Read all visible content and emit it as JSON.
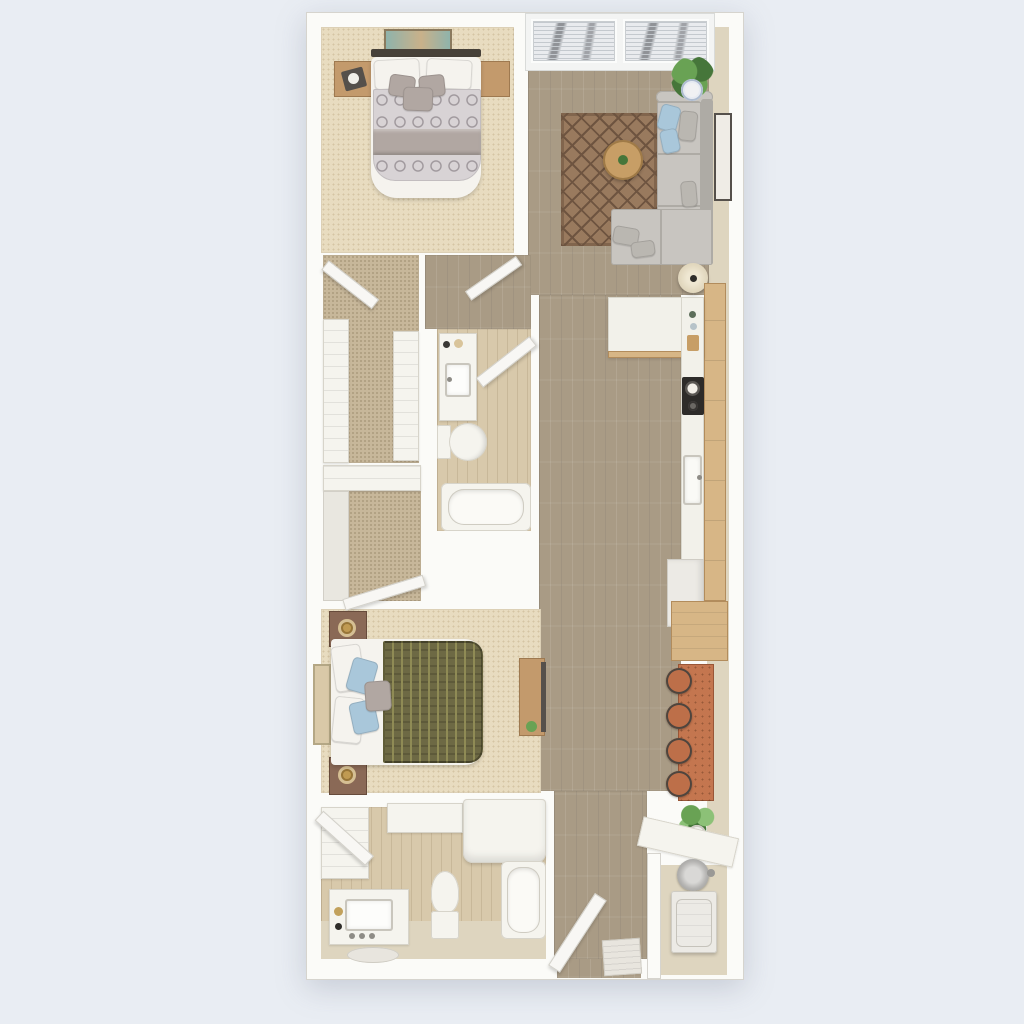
{
  "scene": {
    "label": "Top-down 3D rendered floor plan of a two-bedroom, two-bathroom apartment",
    "view": "top-down 3D render",
    "visible_text": "none"
  },
  "palette": {
    "bg": "#e9edf3",
    "wall": "#fbfbf8",
    "wall_edge": "#d6d4ce",
    "wall_tan": "#ddd3bd",
    "wood": "#a99b85",
    "wood_seam": "#8f8069",
    "bath_floor": "#d8c9ab",
    "floor_tan": "#ded5bf",
    "carpet": "#e8dcc0",
    "carpet_dot": "#d5c5a3",
    "carpet_dark": "#c7b79a",
    "rug": "#997a5e",
    "rug_line": "#6e5440",
    "sofa": "#c8c5c0",
    "sofa_seam": "#aeaba5",
    "pillow_blue": "#a9c7da",
    "pillow_gray": "#bab7b1",
    "table_wood": "#c79e66",
    "counter": "#f2f1ea",
    "cabinet": "#d7b686",
    "cabinet_line": "#b28c5c",
    "stove": "#2d2b29",
    "bar": "#c4764f",
    "stool": "#bd6f49",
    "stool_dark": "#4e453e",
    "plant": "#69a254",
    "plant_dark": "#46763a",
    "fixture": "#f5f4ee",
    "fixture_line": "#d7d4ca",
    "duvet1": "#d8d3d5",
    "duvet1_line": "#a19a9e",
    "blanket": "#b1a7a2",
    "sheet": "#f5f3ee",
    "duvet2": "#6d6944",
    "duvet2_line": "#8f8b55",
    "ns_light": "#c39a6c",
    "ns_dark": "#8a6956",
    "headboard": "#474139",
    "lamp_gold": "#c09a52",
    "heater": "#b4b3b1",
    "washer": "#eceae5",
    "door": "#f8f7f4",
    "door_edge": "#d3d1ca",
    "art_teal": "#8fb3ab",
    "art_sand": "#d9c9a8",
    "frame_dark": "#55504b",
    "blind": "#e9ebee",
    "blind_line": "#c4c9ce",
    "mat": "#e8e5de"
  },
  "rooms": [
    {
      "id": "bedroom-1",
      "label": "Bedroom 1 (top left)",
      "floor": "beige carpet",
      "items": [
        "wall art above headboard",
        "nightstand with decorative tray (left)",
        "nightstand (right)",
        "double bed with metal headboard",
        "2 white pillows",
        "3 taupe accent pillows",
        "ogee-patterned duvet",
        "folded taupe throw blanket"
      ]
    },
    {
      "id": "living-room",
      "label": "Living room (top right)",
      "floor": "hardwood planks",
      "items": [
        "two windows with horizontal blinds",
        "potted plant in corner",
        "patterned brown area rug",
        "gray L-sectional sofa",
        "blue and gray throw pillows",
        "round wood coffee table with small plant",
        "framed wall art on right wall",
        "round cream floor lamp"
      ]
    },
    {
      "id": "kitchen",
      "label": "Galley kitchen (right side)",
      "floor": "hardwood planks",
      "items": [
        "white L-shaped peninsula counter with wood base",
        "wood cabinet run along right wall",
        "black cooktop with pan",
        "undermount sink with faucet",
        "counter bottles",
        "white refrigerator",
        "wood buffet hutch"
      ]
    },
    {
      "id": "dining-nook",
      "label": "Dining bar (right side)",
      "floor": "hardwood planks",
      "items": [
        "terracotta bar-height table",
        "4 round bar stools",
        "potted plant"
      ]
    },
    {
      "id": "walk-in-closet-1",
      "label": "Walk-in closet 1 (middle left)",
      "floor": "dark tan carpet",
      "items": [
        "white shelving left",
        "white shelving right",
        "open closet door"
      ]
    },
    {
      "id": "bathroom-1",
      "label": "Bathroom 1 (middle)",
      "floor": "light wood",
      "items": [
        "vanity with sink and toiletries",
        "toilet",
        "bathtub",
        "open door"
      ]
    },
    {
      "id": "walk-in-closet-2",
      "label": "Walk-in closet 2 (left)",
      "floor": "dark tan carpet",
      "items": [
        "white shelf band",
        "wardrobe unit",
        "open closet door"
      ]
    },
    {
      "id": "bedroom-2",
      "label": "Bedroom 2 / primary (bottom left)",
      "floor": "beige carpet",
      "items": [
        "framed art on left wall",
        "2 dark-wood nightstands with brass lamps",
        "bed with white sheets",
        "white and blue pillows",
        "olive patterned duvet",
        "wood media console with TV"
      ]
    },
    {
      "id": "bathroom-2",
      "label": "Bathroom 2 (bottom)",
      "floor": "light wood with tan border",
      "items": [
        "walk-in closet shelving with open door",
        "white storage counter",
        "white shower/cabinet unit",
        "vanity with sink and faucet knobs",
        "bath mat",
        "toilet",
        "bathtub"
      ]
    },
    {
      "id": "entry",
      "label": "Entry (bottom center)",
      "floor": "hardwood planks",
      "items": [
        "open entry door",
        "striped door mat"
      ]
    },
    {
      "id": "laundry-closet",
      "label": "Laundry/utility closet (bottom right)",
      "floor": "beige",
      "items": [
        "angled white folding counter",
        "round water heater",
        "white washer-dryer unit"
      ]
    }
  ]
}
